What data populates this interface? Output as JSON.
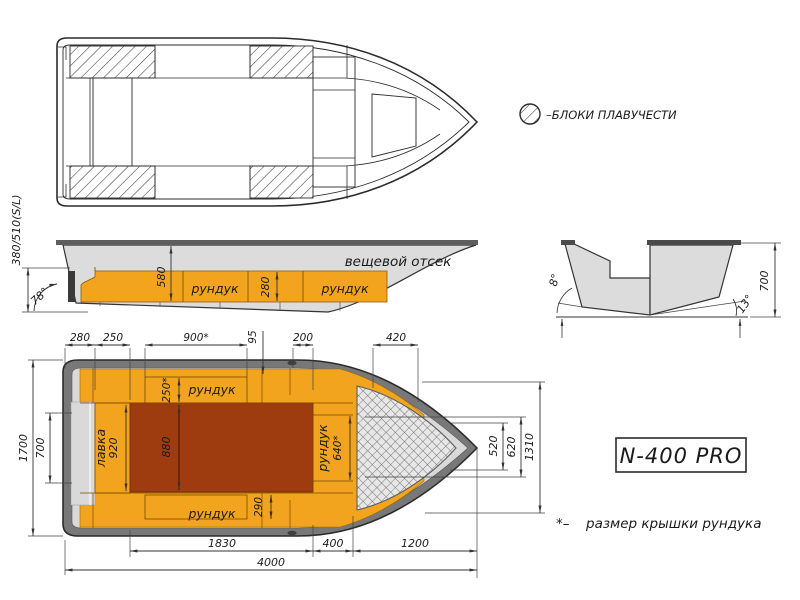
{
  "model": {
    "name": "N-400 PRO"
  },
  "legend": {
    "flotation_label": "–БЛОКИ ПЛАВУЧЕСТИ"
  },
  "footnote": {
    "marker": "*–",
    "text": "размер крышки рундука"
  },
  "side_view": {
    "freeboard_label": "380/510(S/L)",
    "transom_angle": "78°",
    "depth_dim": "580",
    "locker_height_dim": "280",
    "locker_aft_label": "рундук",
    "locker_fwd_label": "рундук",
    "bow_compartment_label": "вещевой отсек"
  },
  "cross_section": {
    "side_angle": "8°",
    "deadrise_angle": "13°",
    "height_dim": "700"
  },
  "plan_view": {
    "dim_280": "280",
    "dim_250": "250",
    "dim_900": "900*",
    "dim_95": "95",
    "dim_200": "200",
    "dim_420": "420",
    "dim_1700": "1700",
    "dim_700": "700",
    "dim_520": "520",
    "dim_620": "620",
    "dim_1310": "1310",
    "dim_1830": "1830",
    "dim_400": "400",
    "dim_1200": "1200",
    "dim_4000": "4000",
    "bench_label": "лавка",
    "bench_dim": "920",
    "floor_dim": "880",
    "locker_top_label": "рундук",
    "locker_top_dim": "250*",
    "locker_bottom_label": "рундук",
    "locker_bottom_dim": "290",
    "locker_bow_label": "рундук",
    "locker_bow_dim": "640*"
  },
  "colors": {
    "orange": "#F2A41F",
    "floor_red": "#9E3C10",
    "hull_gray": "#DCDCDC",
    "gunwale_gray": "#787878",
    "line": "#2B2B2B"
  }
}
